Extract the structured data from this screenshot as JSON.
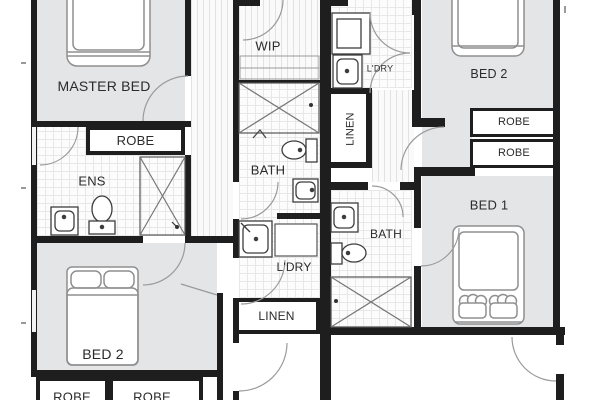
{
  "colors": {
    "wall": "#1e1e1e",
    "carpet": "#e4e5e7",
    "tile_line": "#e7e7e7",
    "label_text": "#2b2b2b",
    "fixture_outline": "#3d3d3d",
    "door_arc": "#9a9a9a"
  },
  "left_unit": {
    "master_bed": "MASTER BED",
    "robe": "ROBE",
    "ens": "ENS",
    "bed2": "BED 2",
    "wip": "WIP",
    "bath": "BATH",
    "ldry": "L'DRY",
    "linen": "LINEN",
    "robe_bottom_1": "ROBE",
    "robe_bottom_2": "ROBE"
  },
  "right_unit": {
    "bed2": "BED 2",
    "ldry": "L'DRY",
    "linen": "LINEN",
    "robe_1": "ROBE",
    "robe_2": "ROBE",
    "bed1": "BED 1",
    "bath": "BATH"
  }
}
